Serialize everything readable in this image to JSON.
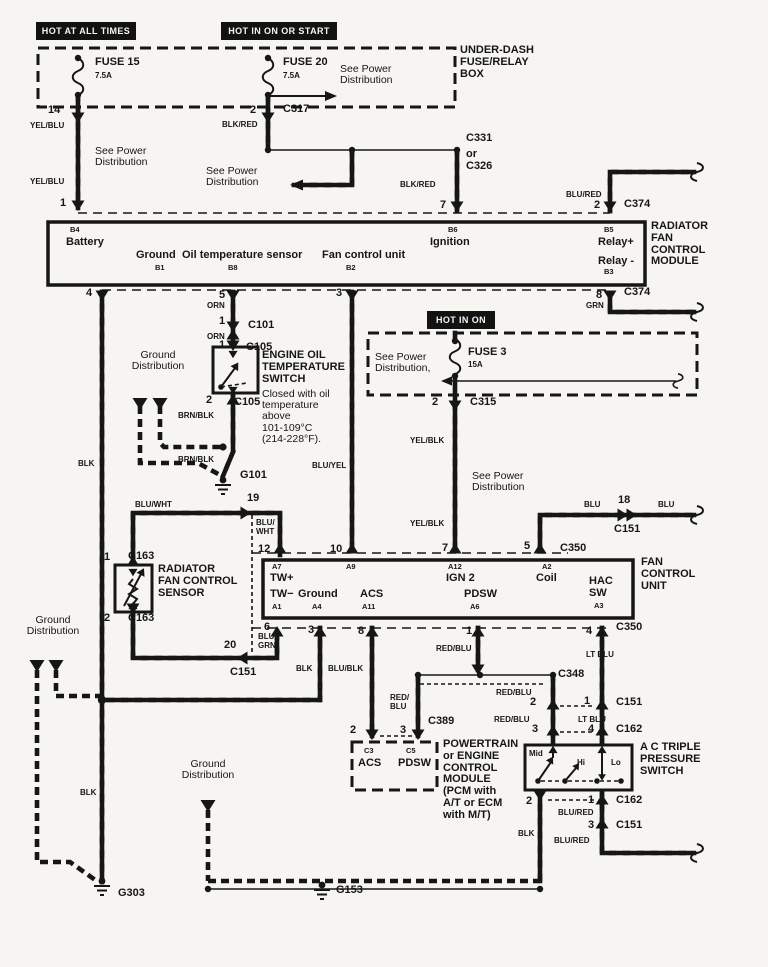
{
  "colors": {
    "ink": "#161616",
    "paper": "#f6f5f1"
  },
  "header_boxes": [
    {
      "n": "hot-at-all-times",
      "text": "HOT AT ALL TIMES",
      "x": 36,
      "y": 22,
      "w": 100,
      "h": 18
    },
    {
      "n": "hot-in-on-or-start",
      "text": "HOT IN ON OR START",
      "x": 221,
      "y": 22,
      "w": 116,
      "h": 18
    },
    {
      "n": "hot-in-on",
      "text": "HOT IN ON",
      "x": 427,
      "y": 311,
      "w": 68,
      "h": 18
    }
  ],
  "labels": [
    {
      "n": "fuse-15",
      "t": "FUSE 15",
      "x": 95,
      "y": 57
    },
    {
      "n": "fuse-15-rating",
      "t": "7.5A",
      "x": 95,
      "y": 72,
      "c": "s"
    },
    {
      "n": "fuse-20",
      "t": "FUSE 20",
      "x": 283,
      "y": 57
    },
    {
      "n": "fuse-20-rating",
      "t": "7.5A",
      "x": 283,
      "y": 72,
      "c": "s"
    },
    {
      "n": "see-power-dist-1",
      "t": "See Power\nDistribution",
      "x": 340,
      "y": 64,
      "c": "r"
    },
    {
      "n": "under-dash-box",
      "t": "UNDER-DASH\nFUSE/RELAY\nBOX",
      "x": 460,
      "y": 45
    },
    {
      "n": "pin-14",
      "t": "14",
      "x": 48,
      "y": 105
    },
    {
      "n": "pin-2-c317",
      "t": "2",
      "x": 250,
      "y": 105
    },
    {
      "n": "c317",
      "t": "C317",
      "x": 283,
      "y": 104
    },
    {
      "n": "blk-red-1",
      "t": "BLK/RED",
      "x": 222,
      "y": 121,
      "c": "s"
    },
    {
      "n": "yel-blu-1",
      "t": "YEL/BLU",
      "x": 30,
      "y": 122,
      "c": "s"
    },
    {
      "n": "see-power-dist-2",
      "t": "See Power\nDistribution",
      "x": 95,
      "y": 146,
      "c": "r"
    },
    {
      "n": "yel-blu-2",
      "t": "YEL/BLU",
      "x": 30,
      "y": 178,
      "c": "s"
    },
    {
      "n": "pin-1-left",
      "t": "1",
      "x": 60,
      "y": 198
    },
    {
      "n": "see-power-dist-3",
      "t": "See Power\nDistribution",
      "x": 206,
      "y": 166,
      "c": "r"
    },
    {
      "n": "c331",
      "t": "C331",
      "x": 466,
      "y": 133
    },
    {
      "n": "or-c326",
      "t": "or\nC326",
      "x": 466,
      "y": 149
    },
    {
      "n": "blk-red-2",
      "t": "BLK/RED",
      "x": 400,
      "y": 181,
      "c": "s"
    },
    {
      "n": "pin-7-top",
      "t": "7",
      "x": 440,
      "y": 200
    },
    {
      "n": "blu-red-1",
      "t": "BLU/RED",
      "x": 566,
      "y": 191,
      "c": "s"
    },
    {
      "n": "pin-2-c374",
      "t": "2",
      "x": 594,
      "y": 200
    },
    {
      "n": "c374-a",
      "t": "C374",
      "x": 624,
      "y": 199
    },
    {
      "n": "radiator-fan-control-module",
      "t": "RADIATOR\nFAN\nCONTROL\nMODULE",
      "x": 651,
      "y": 221
    },
    {
      "n": "b4",
      "t": "B4",
      "x": 70,
      "y": 226,
      "c": "p"
    },
    {
      "n": "battery",
      "t": "Battery",
      "x": 66,
      "y": 237
    },
    {
      "n": "ground-b1",
      "t": "Ground",
      "x": 136,
      "y": 250
    },
    {
      "n": "b1",
      "t": "B1",
      "x": 155,
      "y": 264,
      "c": "p"
    },
    {
      "n": "oil-temperature-sensor",
      "t": "Oil temperature sensor",
      "x": 182,
      "y": 250
    },
    {
      "n": "b8",
      "t": "B8",
      "x": 228,
      "y": 264,
      "c": "p"
    },
    {
      "n": "fan-control-unit-pin",
      "t": "Fan control unit",
      "x": 322,
      "y": 250
    },
    {
      "n": "b2",
      "t": "B2",
      "x": 346,
      "y": 264,
      "c": "p"
    },
    {
      "n": "b6",
      "t": "B6",
      "x": 448,
      "y": 226,
      "c": "p"
    },
    {
      "n": "ignition",
      "t": "Ignition",
      "x": 430,
      "y": 237
    },
    {
      "n": "b5",
      "t": "B5",
      "x": 604,
      "y": 226,
      "c": "p"
    },
    {
      "n": "relay-plus",
      "t": "Relay+",
      "x": 598,
      "y": 237
    },
    {
      "n": "relay-minus",
      "t": "Relay -",
      "x": 598,
      "y": 256
    },
    {
      "n": "b3",
      "t": "B3",
      "x": 604,
      "y": 268,
      "c": "p"
    },
    {
      "n": "pin-4",
      "t": "4",
      "x": 86,
      "y": 288
    },
    {
      "n": "pin-5",
      "t": "5",
      "x": 219,
      "y": 290
    },
    {
      "n": "orn-1",
      "t": "ORN",
      "x": 207,
      "y": 302,
      "c": "s"
    },
    {
      "n": "pin-3-top",
      "t": "3",
      "x": 336,
      "y": 288
    },
    {
      "n": "pin-8-c374",
      "t": "8",
      "x": 596,
      "y": 290
    },
    {
      "n": "grn-1",
      "t": "GRN",
      "x": 586,
      "y": 302,
      "c": "s"
    },
    {
      "n": "c374-b",
      "t": "C374",
      "x": 624,
      "y": 287
    },
    {
      "n": "pin-1-c101",
      "t": "1",
      "x": 219,
      "y": 316
    },
    {
      "n": "c101",
      "t": "C101",
      "x": 248,
      "y": 320
    },
    {
      "n": "orn-2",
      "t": "ORN",
      "x": 207,
      "y": 333,
      "c": "s"
    },
    {
      "n": "pin-1-c105",
      "t": "1",
      "x": 219,
      "y": 340
    },
    {
      "n": "c105-a",
      "t": "C105",
      "x": 246,
      "y": 342
    },
    {
      "n": "engine-oil-temp-switch",
      "t": "ENGINE OIL\nTEMPERATURE\nSWITCH",
      "x": 262,
      "y": 350
    },
    {
      "n": "switch-note",
      "t": "Closed with oil\ntemperature\nabove\n101-109°C\n(214-228°F).",
      "x": 262,
      "y": 389,
      "c": "r"
    },
    {
      "n": "ground-distribution-1",
      "t": "Ground\nDistribution",
      "x": 124,
      "y": 350,
      "c": "r",
      "w": 68
    },
    {
      "n": "pin-2-c105",
      "t": "2",
      "x": 206,
      "y": 395
    },
    {
      "n": "c105-b",
      "t": "C105",
      "x": 234,
      "y": 397
    },
    {
      "n": "brn-blk-1",
      "t": "BRN/BLK",
      "x": 178,
      "y": 412,
      "c": "s"
    },
    {
      "n": "brn-blk-2",
      "t": "BRN/BLK",
      "x": 178,
      "y": 456,
      "c": "s"
    },
    {
      "n": "g101",
      "t": "G101",
      "x": 240,
      "y": 470
    },
    {
      "n": "pin-19",
      "t": "19",
      "x": 247,
      "y": 493
    },
    {
      "n": "blu-wht-1",
      "t": "BLU/WHT",
      "x": 135,
      "y": 501,
      "c": "s"
    },
    {
      "n": "see-power-dist-4",
      "t": "See Power\nDistribution,",
      "x": 375,
      "y": 352,
      "c": "r"
    },
    {
      "n": "fuse-3",
      "t": "FUSE 3",
      "x": 468,
      "y": 347
    },
    {
      "n": "fuse-3-rating",
      "t": "15A",
      "x": 468,
      "y": 361,
      "c": "s"
    },
    {
      "n": "pin-2-c315",
      "t": "2",
      "x": 432,
      "y": 397
    },
    {
      "n": "c315",
      "t": "C315",
      "x": 470,
      "y": 397
    },
    {
      "n": "yel-blk-1",
      "t": "YEL/BLK",
      "x": 410,
      "y": 437,
      "c": "s"
    },
    {
      "n": "see-power-dist-5",
      "t": "See Power\nDistribution",
      "x": 472,
      "y": 471,
      "c": "r"
    },
    {
      "n": "yel-blk-2",
      "t": "YEL/BLK",
      "x": 410,
      "y": 520,
      "c": "s"
    },
    {
      "n": "blu-yel",
      "t": "BLU/YEL",
      "x": 312,
      "y": 462,
      "c": "s"
    },
    {
      "n": "blu-a",
      "t": "BLU",
      "x": 584,
      "y": 501,
      "c": "s"
    },
    {
      "n": "pin-18",
      "t": "18",
      "x": 618,
      "y": 495
    },
    {
      "n": "blu-b",
      "t": "BLU",
      "x": 658,
      "y": 501,
      "c": "s"
    },
    {
      "n": "c151-a",
      "t": "C151",
      "x": 614,
      "y": 524
    },
    {
      "n": "blu-wht-2",
      "t": "BLU/\nWHT",
      "x": 256,
      "y": 519,
      "c": "s"
    },
    {
      "n": "pin-12",
      "t": "12",
      "x": 258,
      "y": 544
    },
    {
      "n": "pin-10",
      "t": "10",
      "x": 330,
      "y": 544
    },
    {
      "n": "pin-7-c350",
      "t": "7",
      "x": 442,
      "y": 543
    },
    {
      "n": "pin-5-c350",
      "t": "5",
      "x": 524,
      "y": 541
    },
    {
      "n": "c350-a",
      "t": "C350",
      "x": 560,
      "y": 543
    },
    {
      "n": "a7",
      "t": "A7",
      "x": 272,
      "y": 563,
      "c": "p"
    },
    {
      "n": "tw-plus",
      "t": "TW+",
      "x": 270,
      "y": 573
    },
    {
      "n": "a9",
      "t": "A9",
      "x": 346,
      "y": 563,
      "c": "p"
    },
    {
      "n": "a12",
      "t": "A12",
      "x": 448,
      "y": 563,
      "c": "p"
    },
    {
      "n": "ign-2",
      "t": "IGN 2",
      "x": 446,
      "y": 573
    },
    {
      "n": "a2",
      "t": "A2",
      "x": 542,
      "y": 563,
      "c": "p"
    },
    {
      "n": "coil",
      "t": "Coil",
      "x": 536,
      "y": 573
    },
    {
      "n": "hac-sw",
      "t": "HAC\nSW",
      "x": 589,
      "y": 576
    },
    {
      "n": "a3",
      "t": "A3",
      "x": 594,
      "y": 602,
      "c": "p"
    },
    {
      "n": "tw-minus",
      "t": "TW−",
      "x": 270,
      "y": 589
    },
    {
      "n": "a1",
      "t": "A1",
      "x": 272,
      "y": 603,
      "c": "p"
    },
    {
      "n": "ground-a4",
      "t": "Ground",
      "x": 298,
      "y": 589
    },
    {
      "n": "a4",
      "t": "A4",
      "x": 312,
      "y": 603,
      "c": "p"
    },
    {
      "n": "acs-a11",
      "t": "ACS",
      "x": 360,
      "y": 589
    },
    {
      "n": "a11",
      "t": "A11",
      "x": 362,
      "y": 603,
      "c": "p"
    },
    {
      "n": "pdsw-a6",
      "t": "PDSW",
      "x": 464,
      "y": 589
    },
    {
      "n": "a6",
      "t": "A6",
      "x": 470,
      "y": 603,
      "c": "p"
    },
    {
      "n": "fan-control-unit",
      "t": "FAN\nCONTROL\nUNIT",
      "x": 641,
      "y": 557
    },
    {
      "n": "pin-6",
      "t": "6",
      "x": 264,
      "y": 622
    },
    {
      "n": "blu-grn-1",
      "t": "BLU/\nGRN",
      "x": 258,
      "y": 633,
      "c": "s"
    },
    {
      "n": "pin-3-gnd",
      "t": "3",
      "x": 308,
      "y": 625
    },
    {
      "n": "pin-8-acs",
      "t": "8",
      "x": 358,
      "y": 626
    },
    {
      "n": "pin-1-pdsw",
      "t": "1",
      "x": 466,
      "y": 626
    },
    {
      "n": "red-blu-1",
      "t": "RED/BLU",
      "x": 436,
      "y": 645,
      "c": "s"
    },
    {
      "n": "pin-4-ltblu",
      "t": "4",
      "x": 586,
      "y": 626
    },
    {
      "n": "c350-b",
      "t": "C350",
      "x": 616,
      "y": 622
    },
    {
      "n": "lt-blu-1",
      "t": "LT BLU",
      "x": 586,
      "y": 651,
      "c": "s"
    },
    {
      "n": "pin-20",
      "t": "20",
      "x": 224,
      "y": 640
    },
    {
      "n": "c151-b",
      "t": "C151",
      "x": 230,
      "y": 667
    },
    {
      "n": "blk-1",
      "t": "BLK",
      "x": 296,
      "y": 665,
      "c": "s"
    },
    {
      "n": "blu-blk",
      "t": "BLU/BLK",
      "x": 328,
      "y": 665,
      "c": "s"
    },
    {
      "n": "red-blu-2",
      "t": "RED/\nBLU",
      "x": 390,
      "y": 694,
      "c": "s"
    },
    {
      "n": "c348",
      "t": "C348",
      "x": 558,
      "y": 669
    },
    {
      "n": "red-blu-3",
      "t": "RED/BLU",
      "x": 496,
      "y": 689,
      "c": "s"
    },
    {
      "n": "pin-2-c151",
      "t": "2",
      "x": 530,
      "y": 697
    },
    {
      "n": "pin-1-c151",
      "t": "1",
      "x": 584,
      "y": 696
    },
    {
      "n": "c151-c",
      "t": "C151",
      "x": 616,
      "y": 697
    },
    {
      "n": "red-blu-4",
      "t": "RED/BLU",
      "x": 494,
      "y": 716,
      "c": "s"
    },
    {
      "n": "pin-3-c162",
      "t": "3",
      "x": 532,
      "y": 724
    },
    {
      "n": "lt-blu-2",
      "t": "LT BLU",
      "x": 578,
      "y": 716,
      "c": "s"
    },
    {
      "n": "pin-4-c162",
      "t": "4",
      "x": 588,
      "y": 724
    },
    {
      "n": "c162-a",
      "t": "C162",
      "x": 616,
      "y": 724
    },
    {
      "n": "c389",
      "t": "C389",
      "x": 428,
      "y": 716
    },
    {
      "n": "pin-2-pcm",
      "t": "2",
      "x": 350,
      "y": 725
    },
    {
      "n": "pin-3-pcm",
      "t": "3",
      "x": 400,
      "y": 725
    },
    {
      "n": "c3",
      "t": "C3",
      "x": 364,
      "y": 747,
      "c": "p"
    },
    {
      "n": "acs-pcm",
      "t": "ACS",
      "x": 358,
      "y": 758
    },
    {
      "n": "c5",
      "t": "C5",
      "x": 406,
      "y": 747,
      "c": "p"
    },
    {
      "n": "pdsw-pcm",
      "t": "PDSW",
      "x": 398,
      "y": 758
    },
    {
      "n": "pcm-label",
      "t": "POWERTRAIN\nor ENGINE\nCONTROL\nMODULE\n(PCM with\nA/T or ECM\nwith M/T)",
      "x": 443,
      "y": 739
    },
    {
      "n": "mid",
      "t": "Mid",
      "x": 529,
      "y": 750,
      "c": "s"
    },
    {
      "n": "hi",
      "t": "Hi",
      "x": 577,
      "y": 759,
      "c": "s"
    },
    {
      "n": "lo",
      "t": "Lo",
      "x": 611,
      "y": 759,
      "c": "s"
    },
    {
      "n": "ac-triple-pressure-switch",
      "t": "A C TRIPLE\nPRESSURE\nSWITCH",
      "x": 640,
      "y": 742
    },
    {
      "n": "pin-2-blk",
      "t": "2",
      "x": 526,
      "y": 796
    },
    {
      "n": "pin-1-c162",
      "t": "1",
      "x": 588,
      "y": 795
    },
    {
      "n": "c162-b",
      "t": "C162",
      "x": 616,
      "y": 795
    },
    {
      "n": "blu-red-2",
      "t": "BLU/RED",
      "x": 558,
      "y": 809,
      "c": "s"
    },
    {
      "n": "pin-3-c151",
      "t": "3",
      "x": 588,
      "y": 820
    },
    {
      "n": "c151-d",
      "t": "C151",
      "x": 616,
      "y": 820
    },
    {
      "n": "blu-red-3",
      "t": "BLU/RED",
      "x": 554,
      "y": 837,
      "c": "s"
    },
    {
      "n": "blk-2",
      "t": "BLK",
      "x": 518,
      "y": 830,
      "c": "s"
    },
    {
      "n": "ground-distribution-2",
      "t": "Ground\nDistribution",
      "x": 13,
      "y": 615,
      "c": "r",
      "w": 80
    },
    {
      "n": "blk-3",
      "t": "BLK",
      "x": 78,
      "y": 460,
      "c": "s"
    },
    {
      "n": "blk-4",
      "t": "BLK",
      "x": 80,
      "y": 789,
      "c": "s"
    },
    {
      "n": "g303",
      "t": "G303",
      "x": 118,
      "y": 888
    },
    {
      "n": "ground-distribution-3",
      "t": "Ground\nDistribution",
      "x": 168,
      "y": 759,
      "c": "r",
      "w": 80
    },
    {
      "n": "g153",
      "t": "G153",
      "x": 336,
      "y": 885
    },
    {
      "n": "radiator-fan-control-sensor",
      "t": "RADIATOR\nFAN CONTROL\nSENSOR",
      "x": 158,
      "y": 564
    },
    {
      "n": "pin-1-c163",
      "t": "1",
      "x": 104,
      "y": 552
    },
    {
      "n": "c163-a",
      "t": "C163",
      "x": 128,
      "y": 551
    },
    {
      "n": "pin-2-c163",
      "t": "2",
      "x": 104,
      "y": 613
    },
    {
      "n": "c163-b",
      "t": "C163",
      "x": 128,
      "y": 613
    }
  ]
}
